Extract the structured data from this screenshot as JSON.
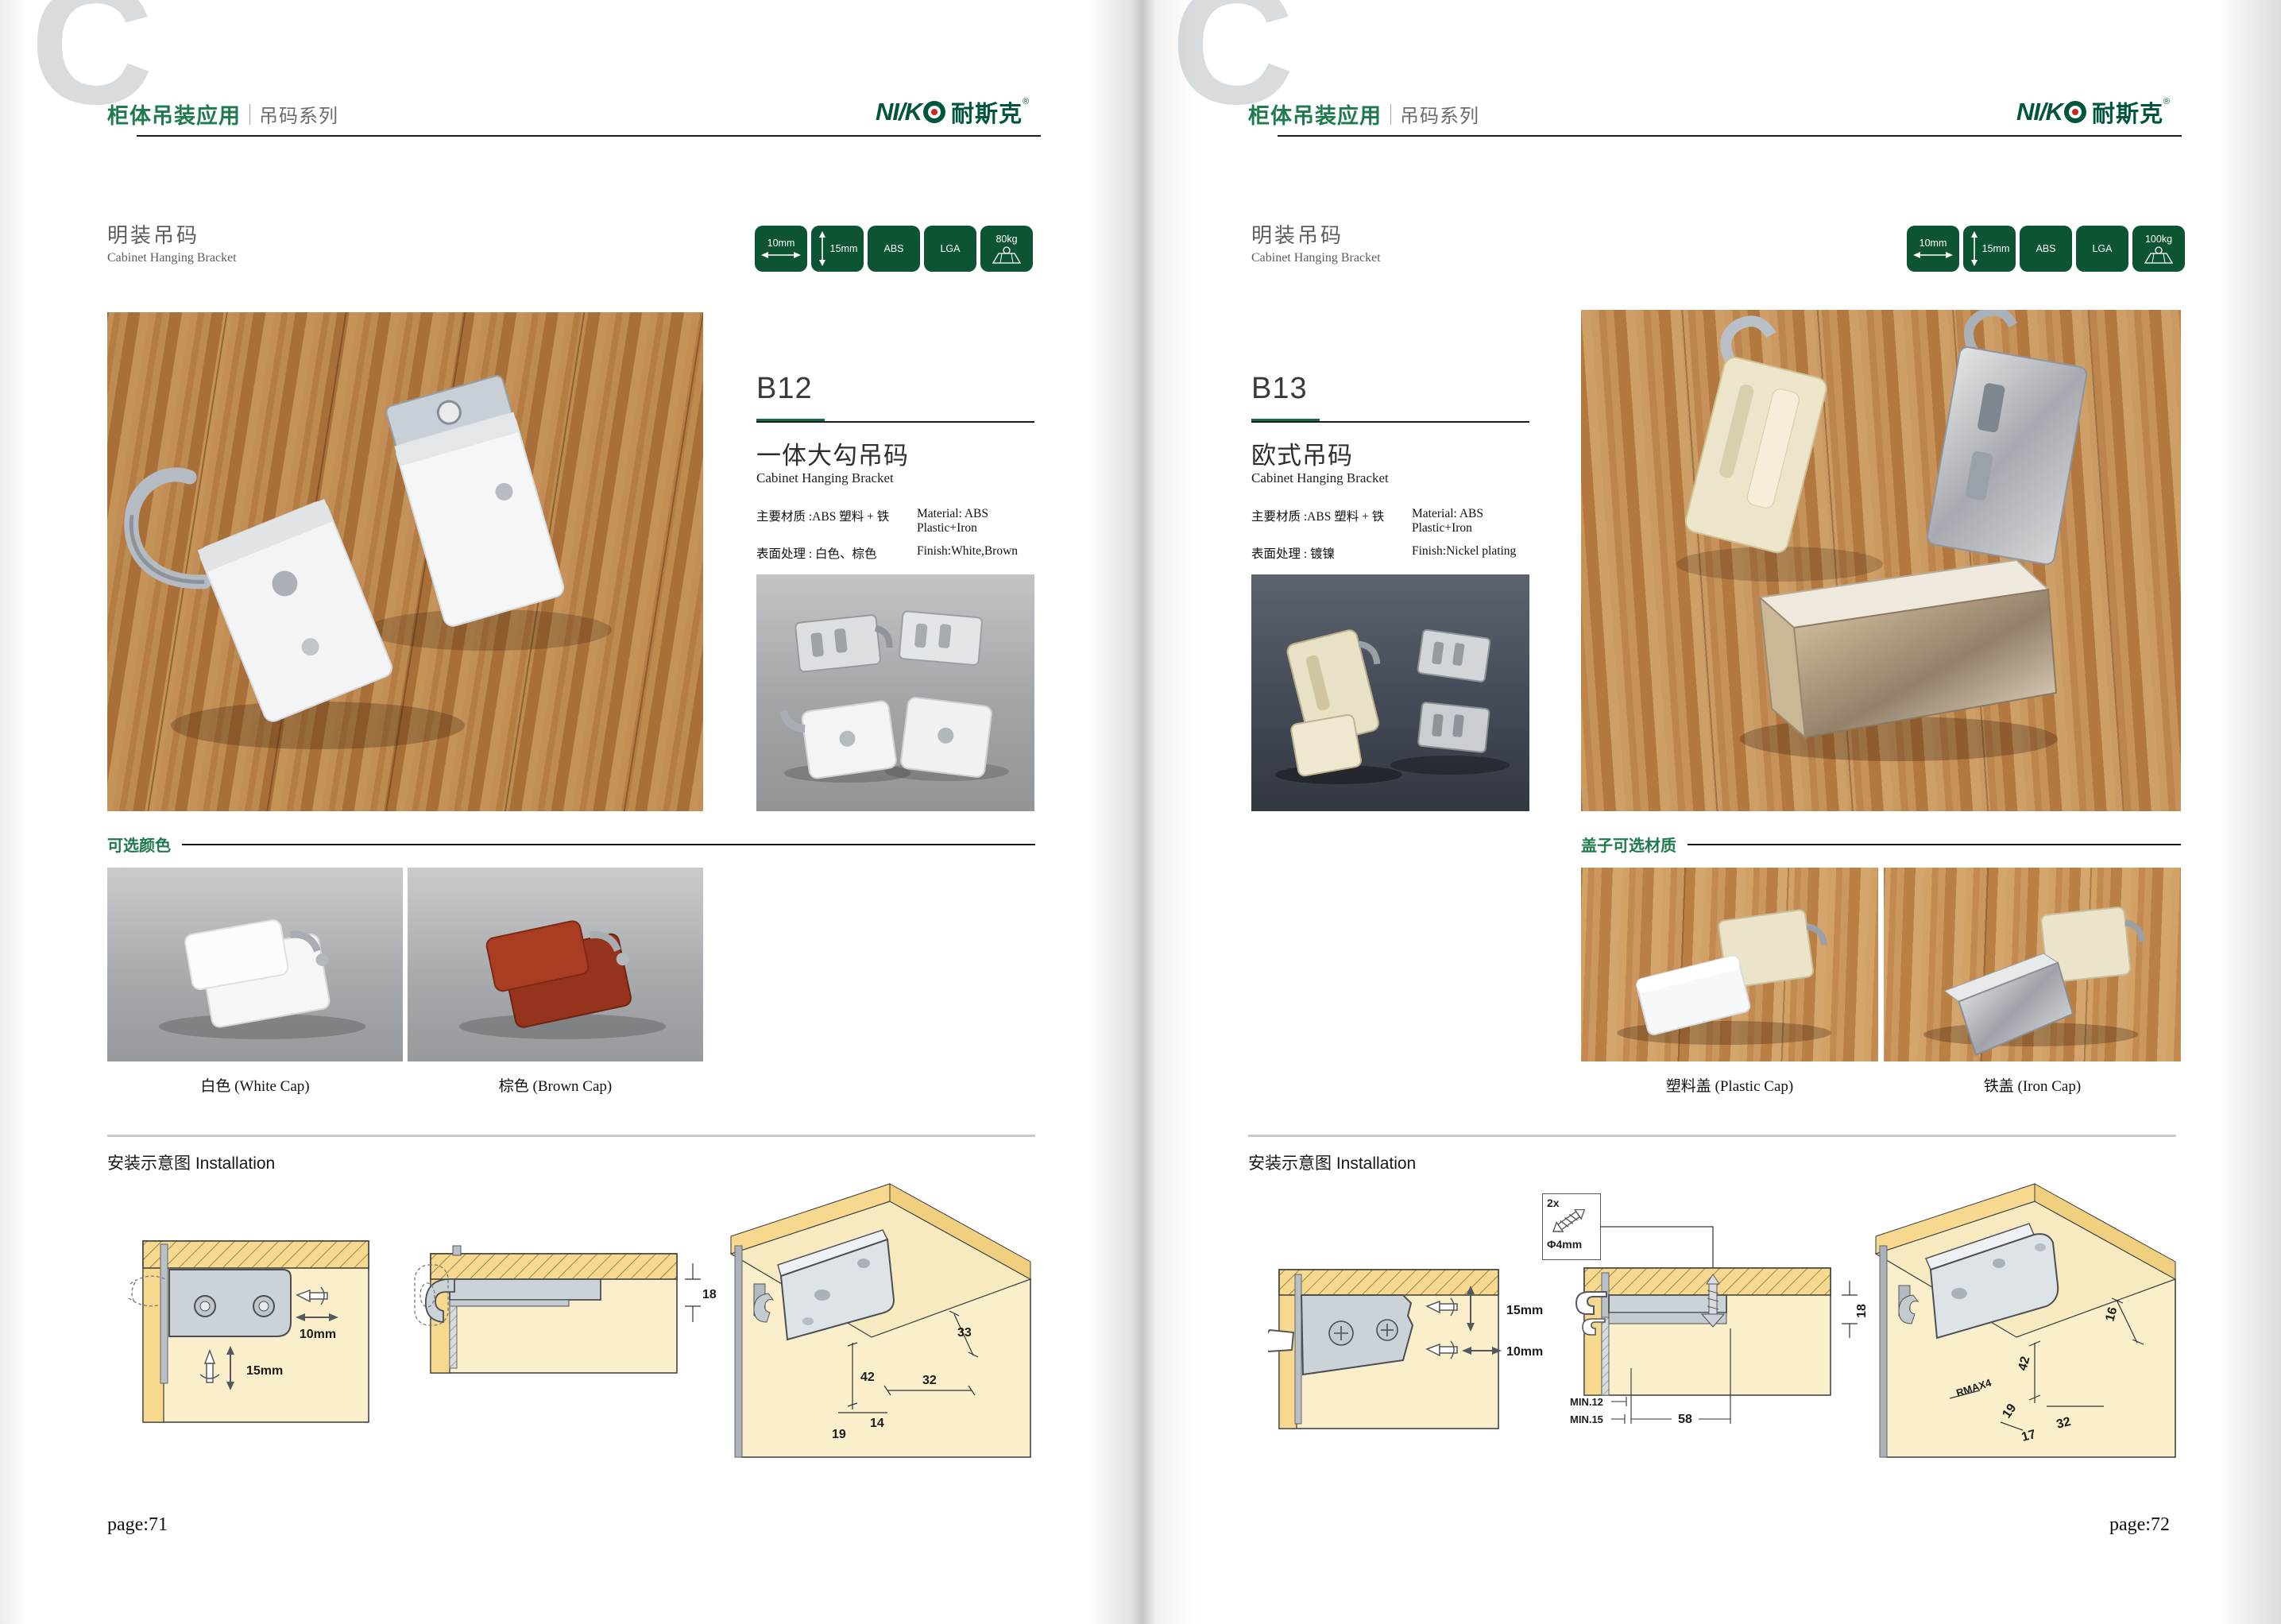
{
  "colors": {
    "accent_green": "#1f7a4d",
    "badge_green": "#0d5434",
    "logo_green": "#00563c",
    "logo_dot_red": "#c8281e",
    "wood_brown": "#b57c44",
    "diagram_tan": "#faeecb",
    "diagram_yellow": "#f6d98e"
  },
  "header": {
    "watermark": "C",
    "title": "柜体吊装应用",
    "series": "吊码系列"
  },
  "brand": {
    "latin": "NI/K",
    "cn": "耐斯克",
    "reg": "®"
  },
  "section": {
    "cn": "明装吊码",
    "en": "Cabinet Hanging Bracket"
  },
  "badges": {
    "dim_w": "10mm",
    "dim_h": "15mm",
    "material": "ABS",
    "cert": "LGA",
    "load_left": "80kg",
    "load_right": "100kg"
  },
  "b12": {
    "code": "B12",
    "name_cn": "一体大勾吊码",
    "name_en": "Cabinet Hanging Bracket",
    "material_cn": "主要材质 :ABS 塑料 + 铁",
    "material_en": "Material: ABS Plastic+Iron",
    "finish_cn": "表面处理 : 白色、棕色",
    "finish_en": "Finish:White,Brown"
  },
  "b13": {
    "code": "B13",
    "name_cn": "欧式吊码",
    "name_en": "Cabinet Hanging Bracket",
    "material_cn": "主要材质 :ABS 塑料 + 铁",
    "material_en": "Material: ABS Plastic+Iron",
    "finish_cn": "表面处理 : 镀镍",
    "finish_en": "Finish:Nickel plating"
  },
  "options_left": {
    "heading": "可选颜色",
    "cap1": "白色 (White Cap)",
    "cap2": "棕色 (Brown Cap)"
  },
  "options_right": {
    "heading": "盖子可选材质",
    "cap1": "塑料盖 (Plastic Cap)",
    "cap2": "铁盖 (Iron Cap)"
  },
  "installation": {
    "heading": "安装示意图 Installation",
    "left": {
      "d1_h": "10mm",
      "d1_v": "15mm",
      "d2": "18",
      "d3_33": "33",
      "d3_42": "42",
      "d3_32": "32",
      "d3_14": "14",
      "d3_19": "19"
    },
    "right": {
      "screw_qty": "2x",
      "screw_dia": "Φ4mm",
      "d1_v": "15mm",
      "d1_h": "10mm",
      "d2_18": "18",
      "d2_min12": "MIN.12",
      "d2_min15": "MIN.15",
      "d2_58": "58",
      "d3_16": "16",
      "d3_42": "42",
      "d3_rmax": "RMAX4",
      "d3_19": "19",
      "d3_17": "17",
      "d3_32": "32"
    }
  },
  "pages": {
    "left_number": "page:71",
    "right_number": "page:72"
  }
}
